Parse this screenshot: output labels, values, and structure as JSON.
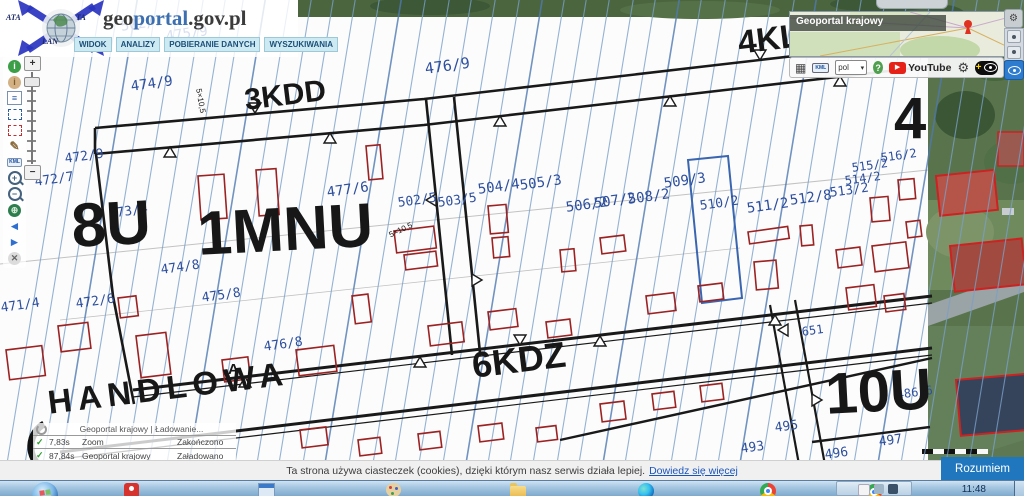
{
  "colors": {
    "parcel_label": "#2d4f9e",
    "zone_label": "#171717",
    "accent": "#2077be",
    "cadastral_line": "#7aa0c8",
    "building_outline": "#9c2222"
  },
  "brand": {
    "title_geo": "geo",
    "title_portal": "portal",
    "title_suffix": ".gov.pl",
    "ring_fragments": [
      "ATA",
      "TA",
      "LAN"
    ],
    "menu": [
      "WIDOK",
      "ANALIZY",
      "POBIERANIE DANYCH",
      "WYSZUKIWANIA"
    ]
  },
  "left_toolbar": {
    "icons": [
      {
        "name": "info-tool-icon",
        "glyph": "i",
        "shape": "circle",
        "bg": "#3c9e46",
        "fg": "#ffffff"
      },
      {
        "name": "identify-tool-icon",
        "glyph": "i",
        "shape": "circle",
        "bg": "#d3b184",
        "fg": "#7a5c2e"
      },
      {
        "name": "legend-tool-icon",
        "glyph": "≡",
        "shape": "square",
        "bg": "#ffffff",
        "fg": "#2f5fa3"
      },
      {
        "name": "select-area-tool-icon",
        "glyph": "",
        "shape": "dashed",
        "bg": "",
        "fg": "#2f5fa3"
      },
      {
        "name": "clear-selection-tool-icon",
        "glyph": "",
        "shape": "dashed",
        "bg": "",
        "fg": "#c03030"
      },
      {
        "name": "measure-tool-icon",
        "glyph": "✎",
        "shape": "none",
        "bg": "",
        "fg": "#8a6a3a"
      },
      {
        "name": "kml-export-tool-icon",
        "glyph": "KML",
        "shape": "chip",
        "bg": "#e8f0fa",
        "fg": "#1a4d9e"
      },
      {
        "name": "zoom-in-tool-icon",
        "glyph": "+",
        "shape": "lens",
        "bg": "",
        "fg": "#44617e"
      },
      {
        "name": "zoom-out-tool-icon",
        "glyph": "−",
        "shape": "lens",
        "bg": "",
        "fg": "#44617e"
      },
      {
        "name": "full-extent-globe-icon",
        "glyph": "⊕",
        "shape": "circle",
        "bg": "#2e7d4f",
        "fg": "#d8ecd8"
      },
      {
        "name": "previous-view-arrow-icon",
        "glyph": "◄",
        "shape": "none",
        "bg": "",
        "fg": "#2f6fd0"
      },
      {
        "name": "next-view-arrow-icon",
        "glyph": "►",
        "shape": "none",
        "bg": "",
        "fg": "#2f6fd0"
      },
      {
        "name": "clear-map-icon",
        "glyph": "✕",
        "shape": "circle",
        "bg": "#dcdcdc",
        "fg": "#666666"
      }
    ]
  },
  "zoom_slider": {
    "plus": "+",
    "minus": "−"
  },
  "overview": {
    "title": "Geoportal krajowy"
  },
  "mini_toolbar": {
    "grid_icon": "▦",
    "kml": "KML",
    "lang": "pol",
    "caret_icon": "▾",
    "help": "?",
    "youtube_play_icon": "▶",
    "youtube": "YouTube",
    "gear_icon": "⚙",
    "plus_icon": "+"
  },
  "map": {
    "labels": [
      {
        "t": "502/7",
        "x": 120,
        "y": 20,
        "s": 14,
        "r": -8,
        "c": "blue"
      },
      {
        "t": "475/9",
        "x": 165,
        "y": 30,
        "s": 14,
        "r": -8,
        "c": "blue"
      },
      {
        "t": "476/9",
        "x": 424,
        "y": 62,
        "s": 15,
        "r": -8,
        "c": "blue"
      },
      {
        "t": "474/9",
        "x": 130,
        "y": 80,
        "s": 14,
        "r": -8,
        "c": "blue"
      },
      {
        "t": "472/9",
        "x": 64,
        "y": 153,
        "s": 13,
        "r": -8,
        "c": "blue"
      },
      {
        "t": "472/7",
        "x": 34,
        "y": 176,
        "s": 13,
        "r": -8,
        "c": "blue"
      },
      {
        "t": "473/4",
        "x": 108,
        "y": 208,
        "s": 13,
        "r": -8,
        "c": "blue"
      },
      {
        "t": "477/6",
        "x": 326,
        "y": 186,
        "s": 14,
        "r": -8,
        "c": "blue"
      },
      {
        "t": "502/5",
        "x": 397,
        "y": 197,
        "s": 13,
        "r": -8,
        "c": "blue"
      },
      {
        "t": "503/5",
        "x": 437,
        "y": 197,
        "s": 13,
        "r": -8,
        "c": "blue"
      },
      {
        "t": "504/4",
        "x": 477,
        "y": 183,
        "s": 14,
        "r": -8,
        "c": "blue"
      },
      {
        "t": "505/3",
        "x": 519,
        "y": 179,
        "s": 14,
        "r": -8,
        "c": "blue"
      },
      {
        "t": "506/2",
        "x": 565,
        "y": 201,
        "s": 14,
        "r": -8,
        "c": "blue"
      },
      {
        "t": "507/2",
        "x": 593,
        "y": 197,
        "s": 14,
        "r": -8,
        "c": "blue"
      },
      {
        "t": "508/2",
        "x": 627,
        "y": 193,
        "s": 14,
        "r": -8,
        "c": "blue"
      },
      {
        "t": "509/3",
        "x": 663,
        "y": 177,
        "s": 14,
        "r": -8,
        "c": "blue"
      },
      {
        "t": "510/2",
        "x": 699,
        "y": 200,
        "s": 13,
        "r": -8,
        "c": "blue"
      },
      {
        "t": "511/2",
        "x": 746,
        "y": 202,
        "s": 14,
        "r": -8,
        "c": "blue"
      },
      {
        "t": "512/8",
        "x": 789,
        "y": 194,
        "s": 14,
        "r": -8,
        "c": "blue"
      },
      {
        "t": "513/2",
        "x": 829,
        "y": 187,
        "s": 13,
        "r": -8,
        "c": "blue"
      },
      {
        "t": "514/2",
        "x": 844,
        "y": 175,
        "s": 12,
        "r": -8,
        "c": "blue"
      },
      {
        "t": "515/2",
        "x": 851,
        "y": 162,
        "s": 12,
        "r": -8,
        "c": "blue"
      },
      {
        "t": "516/2",
        "x": 880,
        "y": 152,
        "s": 12,
        "r": -8,
        "c": "blue"
      },
      {
        "t": "471/4",
        "x": 0,
        "y": 302,
        "s": 13,
        "r": -8,
        "c": "blue"
      },
      {
        "t": "472/6",
        "x": 75,
        "y": 298,
        "s": 13,
        "r": -8,
        "c": "blue"
      },
      {
        "t": "474/8",
        "x": 160,
        "y": 264,
        "s": 13,
        "r": -8,
        "c": "blue"
      },
      {
        "t": "475/8",
        "x": 201,
        "y": 292,
        "s": 13,
        "r": -8,
        "c": "blue"
      },
      {
        "t": "476/8",
        "x": 263,
        "y": 341,
        "s": 13,
        "r": -8,
        "c": "blue"
      },
      {
        "t": "651",
        "x": 801,
        "y": 326,
        "s": 12,
        "r": -8,
        "c": "blue"
      },
      {
        "t": "495",
        "x": 774,
        "y": 422,
        "s": 13,
        "r": -8,
        "c": "blue"
      },
      {
        "t": "497",
        "x": 878,
        "y": 436,
        "s": 13,
        "r": -8,
        "c": "blue"
      },
      {
        "t": "496",
        "x": 824,
        "y": 449,
        "s": 13,
        "r": -8,
        "c": "blue"
      },
      {
        "t": "493",
        "x": 740,
        "y": 443,
        "s": 13,
        "r": -8,
        "c": "blue"
      },
      {
        "t": "486/6",
        "x": 896,
        "y": 389,
        "s": 12,
        "r": -8,
        "c": "blue"
      },
      {
        "t": "3KDD",
        "x": 243,
        "y": 86,
        "s": 30,
        "r": -7,
        "c": "black",
        "w": 1
      },
      {
        "t": "4KL",
        "x": 736,
        "y": 26,
        "s": 33,
        "r": -7,
        "c": "black",
        "w": 1
      },
      {
        "t": "8U",
        "x": 70,
        "y": 196,
        "s": 62,
        "r": -3,
        "c": "black",
        "w": 1
      },
      {
        "t": "1MNU",
        "x": 196,
        "y": 204,
        "s": 62,
        "r": -3,
        "c": "black",
        "w": 1
      },
      {
        "t": "6KDZ",
        "x": 470,
        "y": 348,
        "s": 36,
        "r": -7,
        "c": "black",
        "w": 1
      },
      {
        "t": "HANDLOWA",
        "x": 46,
        "y": 386,
        "s": 33,
        "r": -7,
        "c": "black",
        "w": 1,
        "ls": 6
      },
      {
        "t": "10U",
        "x": 824,
        "y": 366,
        "s": 58,
        "r": -3,
        "c": "black",
        "w": 1
      },
      {
        "t": "4",
        "x": 894,
        "y": 90,
        "s": 58,
        "r": 0,
        "c": "black",
        "w": 1
      },
      {
        "t": "A",
        "x": 228,
        "y": 362,
        "s": 15,
        "r": 0,
        "c": "black",
        "w": 1
      },
      {
        "t": "5×10,5",
        "x": 202,
        "y": 88,
        "s": 8,
        "r": 80,
        "c": "black"
      },
      {
        "t": "5×10,5",
        "x": 388,
        "y": 232,
        "s": 8,
        "r": -25,
        "c": "black"
      }
    ]
  },
  "status_panel": {
    "rows": [
      {
        "icon": "spinner",
        "text": "Geoportal krajowy | Ładowanie..."
      },
      {
        "icon": "check",
        "time": "7,83s",
        "layer": "Zoom",
        "status": "Zakończono"
      },
      {
        "icon": "check",
        "time": "87,84s",
        "layer": "Geoportal krajowy",
        "status": "Załadowano"
      }
    ]
  },
  "cookie_bar": {
    "message": "Ta strona używa ciasteczek (cookies), dzięki którym nasz serwis działa lepiej.",
    "link": "Dowiedz się więcej",
    "accept": "Rozumiem"
  },
  "taskbar": {
    "clock": "11:48",
    "icons": [
      "pinned-app-red",
      "system-window-app",
      "paint-app",
      "file-explorer",
      "edge-browser",
      "chrome-browser",
      "chrome-browser-active"
    ]
  }
}
